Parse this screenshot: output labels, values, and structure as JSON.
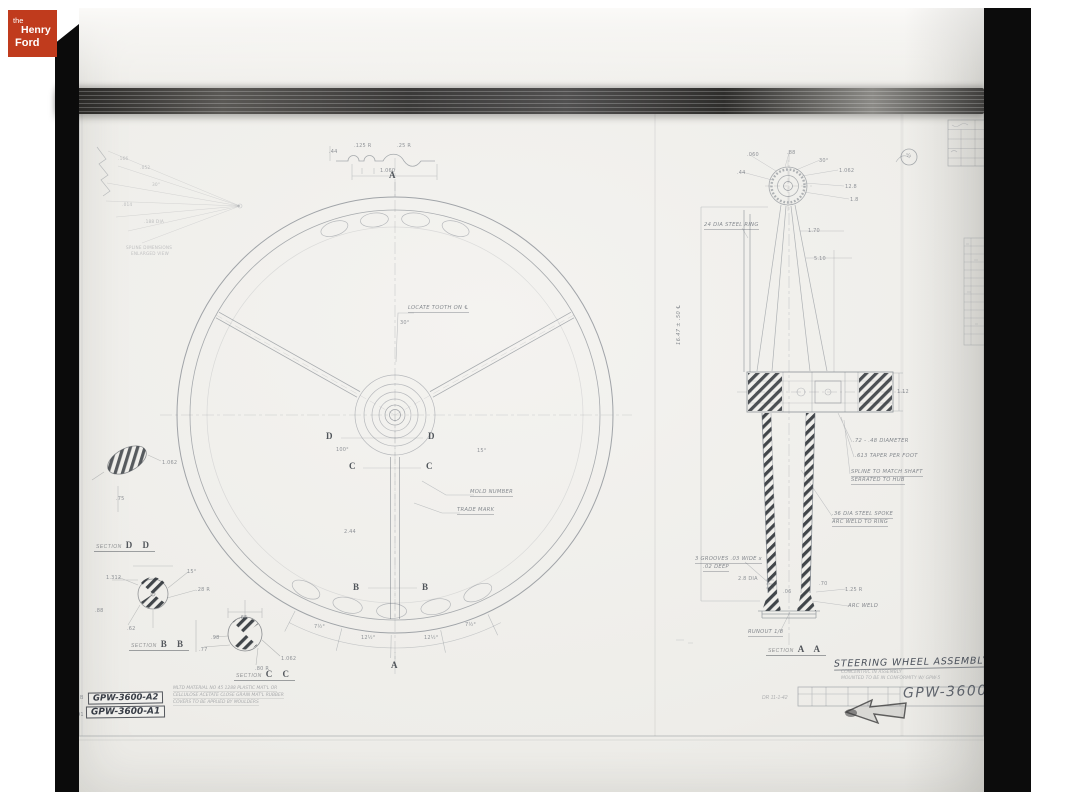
{
  "logo": {
    "line1": "the",
    "line2": "Henry",
    "line3": "Ford",
    "bg_color": "#c03b1d"
  },
  "title_block": {
    "title": "STEERING WHEEL ASSEMBLY",
    "note1": "CONCENTRIC IN ASSEMBLY",
    "note2": "MOUNTED TO BE IN CONFORMITY W/ GPW-5",
    "drawing_number": "GPW-3600A",
    "date": "DR 11-1-42"
  },
  "stamps": {
    "top": "GPW-3600-A2",
    "bottom": "GPW-3600-A1",
    "edge_letter": "B",
    "edge_number": "191"
  },
  "material_note": {
    "line1": "MLTD MATERIAL NO 45 1288 PLASTIC MAT'L OR",
    "line2": "CELLULOSE ACETATE CLOSE GRAIN MAT'L RUBBER",
    "line3": "COVERS TO BE APPLIED BY MOULDERS"
  },
  "callouts": {
    "locate_tooth": "LOCATE TOOTH ON ℄",
    "mold_number": "MOLD NUMBER",
    "trade_mark": "TRADE MARK",
    "steel_ring": "24 DIA STEEL RING",
    "shaft_length": "16.47 ± .50 ℄",
    "diameter_note": ".72 - .48 DIAMETER",
    "taper_note": ".613 TAPER PER FOOT",
    "spline_note1": "SPLINE TO MATCH SHAFT",
    "spline_note2": "SERRATED TO HUB",
    "spoke_note1": ".36 DIA STEEL SPOKE",
    "spoke_note2": "ARC WELD TO RING",
    "grooves_note1": "3 GROOVES .03 WIDE x",
    "grooves_note2": ".02 DEEP",
    "arc_weld": "ARC WELD",
    "runout": "RUNOUT 1/8"
  },
  "sections": {
    "label": "SECTION",
    "aa": "A A",
    "bb": "B B",
    "cc": "C C",
    "dd": "D D"
  },
  "view_letters": {
    "a_top": "A",
    "a_bottom": "A",
    "b_left": "B",
    "b_right": "B",
    "c_left": "C",
    "c_right": "C",
    "d_left": "D",
    "d_right": "D"
  },
  "dims": [
    {
      "t": ".166",
      "x": 118,
      "y": 157,
      "o": 0.3,
      "s": 4.3
    },
    {
      "t": ".052",
      "x": 140,
      "y": 166,
      "o": 0.3,
      "s": 4.3
    },
    {
      "t": "30°",
      "x": 152,
      "y": 183,
      "o": 0.3,
      "s": 4.3
    },
    {
      "t": ".014",
      "x": 122,
      "y": 203,
      "o": 0.3,
      "s": 4.3
    },
    {
      "t": ".188 DIA",
      "x": 144,
      "y": 220,
      "o": 0.3,
      "s": 4.3
    },
    {
      "t": "SPLINE DIMENSIONS",
      "x": 126,
      "y": 245,
      "o": 0.28,
      "s": 4.2
    },
    {
      "t": "ENLARGED VIEW",
      "x": 131,
      "y": 251,
      "o": 0.28,
      "s": 4.2
    },
    {
      "t": ".44",
      "x": 329,
      "y": 149
    },
    {
      "t": ".125 R",
      "x": 354,
      "y": 143
    },
    {
      "t": ".25 R",
      "x": 397,
      "y": 143
    },
    {
      "t": "1.060",
      "x": 380,
      "y": 168
    },
    {
      "t": "30°",
      "x": 400,
      "y": 320
    },
    {
      "t": "100°",
      "x": 336,
      "y": 447
    },
    {
      "t": "15°",
      "x": 477,
      "y": 448
    },
    {
      "t": "2.44",
      "x": 344,
      "y": 529
    },
    {
      "t": "7½°",
      "x": 314,
      "y": 624
    },
    {
      "t": "12½°",
      "x": 361,
      "y": 635
    },
    {
      "t": "12½°",
      "x": 424,
      "y": 635
    },
    {
      "t": "7½°",
      "x": 465,
      "y": 622
    },
    {
      "t": "1.062",
      "x": 162,
      "y": 460
    },
    {
      "t": ".75",
      "x": 116,
      "y": 496
    },
    {
      "t": "1.312",
      "x": 106,
      "y": 575
    },
    {
      "t": "15°",
      "x": 187,
      "y": 569
    },
    {
      "t": ".28 R",
      "x": 196,
      "y": 587
    },
    {
      "t": ".88",
      "x": 95,
      "y": 608
    },
    {
      "t": ".62",
      "x": 127,
      "y": 626
    },
    {
      "t": ".65",
      "x": 239,
      "y": 615
    },
    {
      "t": ".98",
      "x": 211,
      "y": 635
    },
    {
      "t": ".77",
      "x": 199,
      "y": 647
    },
    {
      "t": "1.062",
      "x": 281,
      "y": 656
    },
    {
      "t": ".80 R",
      "x": 255,
      "y": 666
    },
    {
      "t": ".060",
      "x": 747,
      "y": 152
    },
    {
      "t": ".88",
      "x": 787,
      "y": 150
    },
    {
      "t": "30°",
      "x": 819,
      "y": 158
    },
    {
      "t": "1.062",
      "x": 839,
      "y": 168
    },
    {
      "t": "12.8",
      "x": 845,
      "y": 184
    },
    {
      "t": "1.8",
      "x": 850,
      "y": 197
    },
    {
      "t": ".44",
      "x": 737,
      "y": 170
    },
    {
      "t": "1.70",
      "x": 808,
      "y": 228
    },
    {
      "t": "5.10",
      "x": 814,
      "y": 256
    },
    {
      "t": "1.12",
      "x": 897,
      "y": 389
    },
    {
      "t": "2.8 DIA",
      "x": 738,
      "y": 576
    },
    {
      "t": ".70",
      "x": 819,
      "y": 581
    },
    {
      "t": "1.25 R",
      "x": 845,
      "y": 587
    },
    {
      "t": ".06",
      "x": 783,
      "y": 589
    },
    {
      "t": "¼",
      "x": 906,
      "y": 153
    }
  ]
}
